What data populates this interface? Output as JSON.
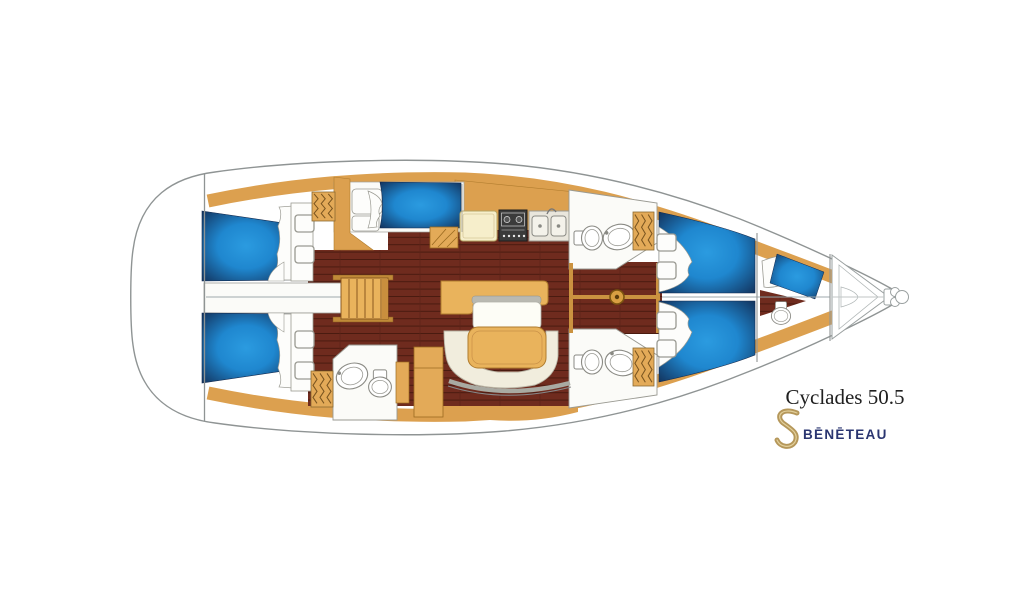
{
  "branding": {
    "model": "Cyclades 50.5",
    "brand": "BĒNĒTEAU",
    "logo": "beneteau-gold-s-swan"
  },
  "colors": {
    "background": "#ffffff",
    "hull_outline": "#8f9494",
    "deck_trim_wood": "#dca04f",
    "furniture_wood": "#e9b35c",
    "berth_blue_center": "#2b9be0",
    "berth_blue_edge": "#123059",
    "floor_wood": "#6f2b1e",
    "floor_plank_line": "#4a1b10",
    "counter_cream": "#f6eecb",
    "stove_black": "#3b3b3b",
    "settee_white": "#f1eddd",
    "trim_gray": "#a9aaa2",
    "brand_navy": "#2a3570",
    "logo_gold": "#b5975a"
  },
  "diagram": {
    "type": "sailing-yacht-interior-floorplan",
    "orientation": "bow-right-stern-left",
    "features": [
      "stern-platform",
      "aft-cabin-port",
      "aft-cabin-starboard",
      "companionway-steps",
      "wardrobe-louver-lockers",
      "galley-counter",
      "galley-stove",
      "galley-double-sink",
      "chart-table",
      "salon-table",
      "salon-u-settee",
      "salon-bench",
      "head-aft-with-sink-and-toilet",
      "head-forward-port",
      "head-forward-starboard",
      "forward-cabin-port-v-berth",
      "forward-cabin-starboard-v-berth",
      "crew-cabin-with-berth-seat-toilet",
      "anchor-locker",
      "bow-roller-fitting",
      "mast-step",
      "deck-hatches",
      "centerline"
    ]
  }
}
